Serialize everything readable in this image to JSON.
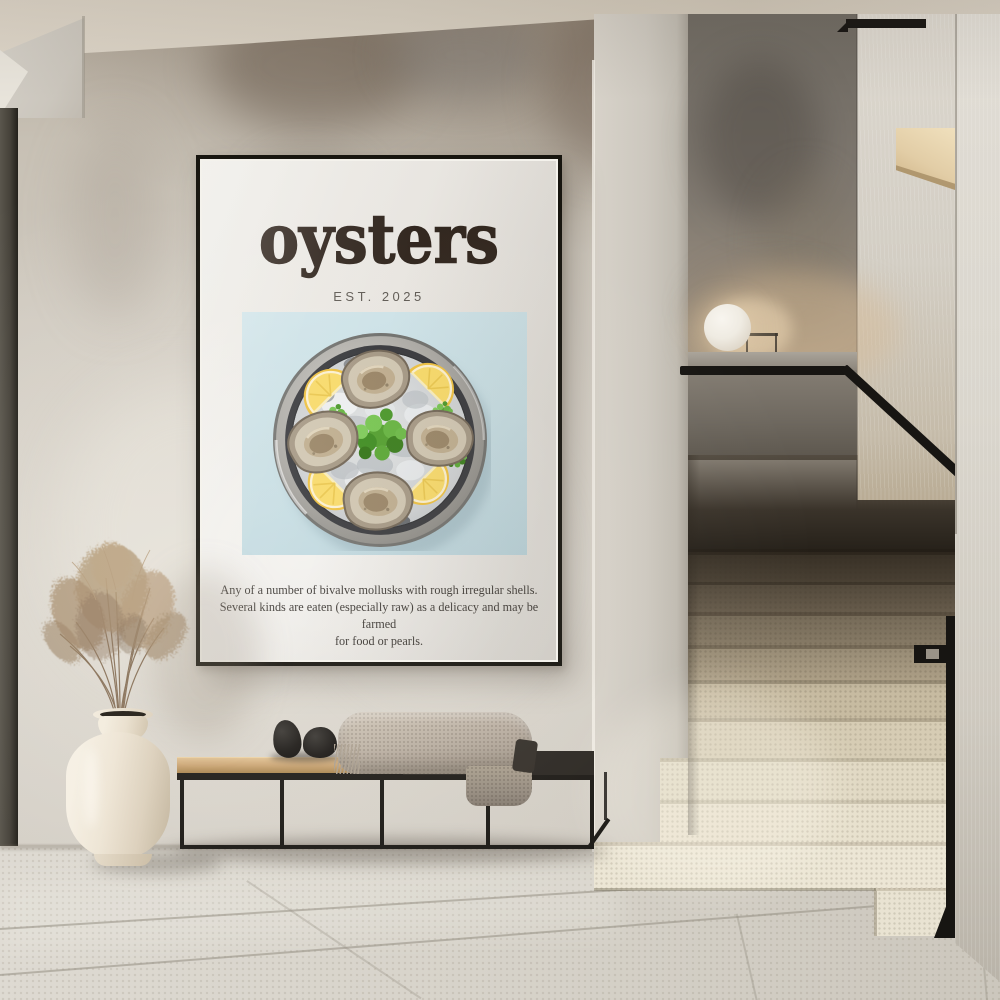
{
  "scene": {
    "type": "interior-photograph",
    "setting": "minimalist hallway with plaster walls, terrazzo staircase, bench and framed food-art poster",
    "objects": [
      "framed poster",
      "staircase",
      "black handrail",
      "sphere lamp",
      "wood wall niche",
      "metal-frame bench",
      "knit cushion",
      "two black decor pebbles",
      "cream ceramic vase",
      "dried pampas grass",
      "stone tile floor",
      "dark doorway edge"
    ]
  },
  "poster": {
    "title": "oysters",
    "established": "EST. 2025",
    "caption_line1": "Any of a number of bivalve mollusks with rough irregular shells.",
    "caption_line2": "Several kinds are eaten (especially raw) as a delicacy and may be farmed",
    "caption_line3": "for food or pearls.",
    "artwork": {
      "subject": "overhead plate of four oysters on crushed ice",
      "oysters": 4,
      "lemon_wedges": 4,
      "garnish": "parsley sprigs",
      "background_hex": "#c6dde3",
      "plate_hex": "#2b2c2e",
      "lemon_hex": "#f5d166",
      "parsley_hex": "#55a233",
      "oyster_shell_hex": "#a39682"
    },
    "colors": {
      "paper_hex": "#e6e3de",
      "frame_hex": "#17150f",
      "title_hex": "#2f241c",
      "established_hex": "#5d5852",
      "caption_hex": "#3b3733"
    }
  },
  "palette": {
    "wall_hex": "#d0cbc2",
    "ceiling_hex": "#d8d0c2",
    "floor_hex": "#d8d4cb",
    "stair_stone_hex": "#e7e0cd",
    "stair_shadow_hex": "#6a5f4f",
    "handrail_hex": "#171512",
    "bench_wood_hex": "#c9a673",
    "bench_dark_top_hex": "#2e2a25",
    "cushion_hex": "#b3a89b",
    "pebble_hex": "#1e1c19",
    "vase_hex": "#ece4d6",
    "grass_hex": "#b29877",
    "lamp_hex": "#f3f0e9",
    "niche_wood_hex": "#e2cda6"
  }
}
